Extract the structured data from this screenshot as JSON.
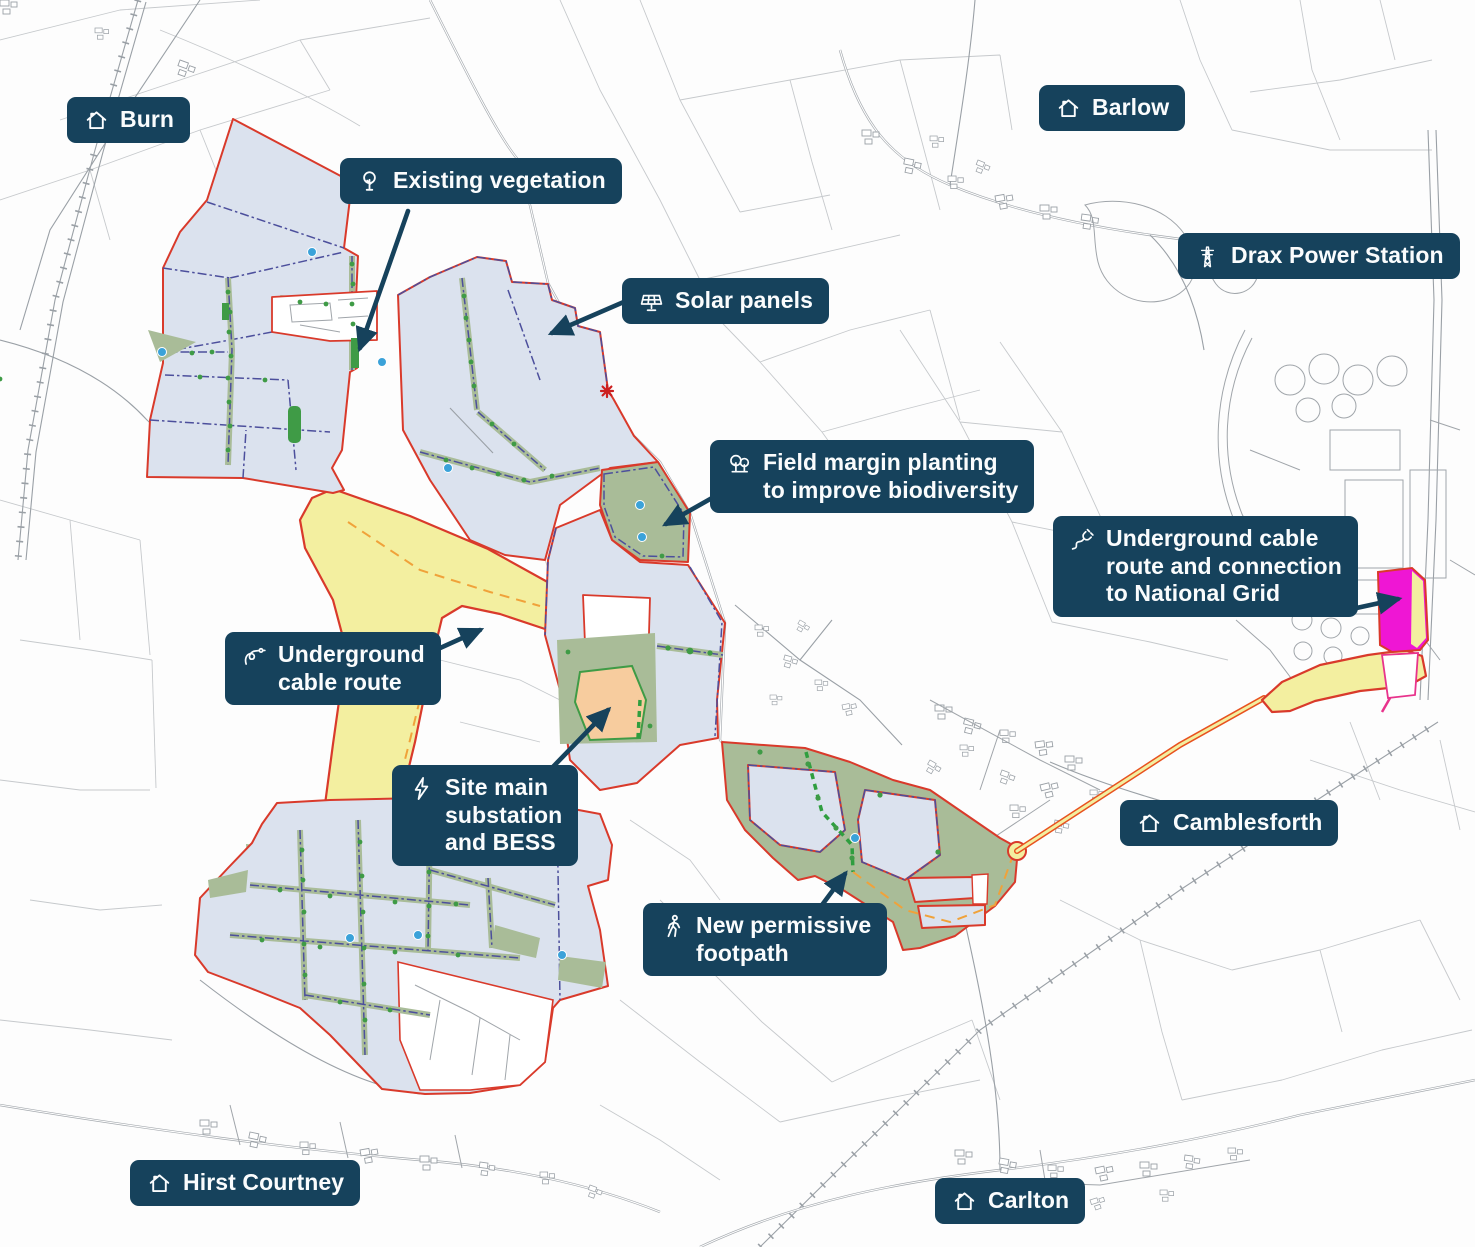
{
  "annotations": {
    "burn": {
      "icon": "house",
      "text": "Burn"
    },
    "existing_vegetation": {
      "icon": "tree",
      "text": "Existing vegetation"
    },
    "solar_panels": {
      "icon": "solar-panel",
      "text": "Solar panels"
    },
    "barlow": {
      "icon": "house",
      "text": "Barlow"
    },
    "drax": {
      "icon": "pylon",
      "text": "Drax Power Station"
    },
    "field_margin": {
      "icon": "trees",
      "text": "Field margin planting\nto improve biodiversity"
    },
    "ug_grid": {
      "icon": "plug",
      "text": "Underground cable\nroute and connection\nto National Grid"
    },
    "ug_cable": {
      "icon": "cable",
      "text": "Underground\ncable route"
    },
    "substation": {
      "icon": "bolt",
      "text": "Site main\nsubstation\nand BESS"
    },
    "footpath": {
      "icon": "walker",
      "text": "New permissive\nfootpath"
    },
    "camblesforth": {
      "icon": "house",
      "text": "Camblesforth"
    },
    "hirst_courtney": {
      "icon": "house",
      "text": "Hirst Courtney"
    },
    "carlton": {
      "icon": "house",
      "text": "Carlton"
    }
  },
  "colors": {
    "label_background": "#16425c",
    "label_text": "#fafcfd",
    "site_boundary_red": "#d93a2b",
    "site_fill_blue": "#dbe2ee",
    "cable_corridor_yellow": "#f3efa0",
    "field_margin_green": "#a9bc98",
    "hedgerow_green": "#3f9b46",
    "substation_orange": "#f7cc9e",
    "grid_connection_magenta": "#ef16d4",
    "cable_route_orange": "#e8521f",
    "footpath_dash_green": "#2f9e3f",
    "internal_boundary_navy": "#4c4f9c",
    "water_point_blue": "#3ba2d9",
    "arrow_navy": "#16425c",
    "base_map_gray": "#b9bdc2"
  }
}
